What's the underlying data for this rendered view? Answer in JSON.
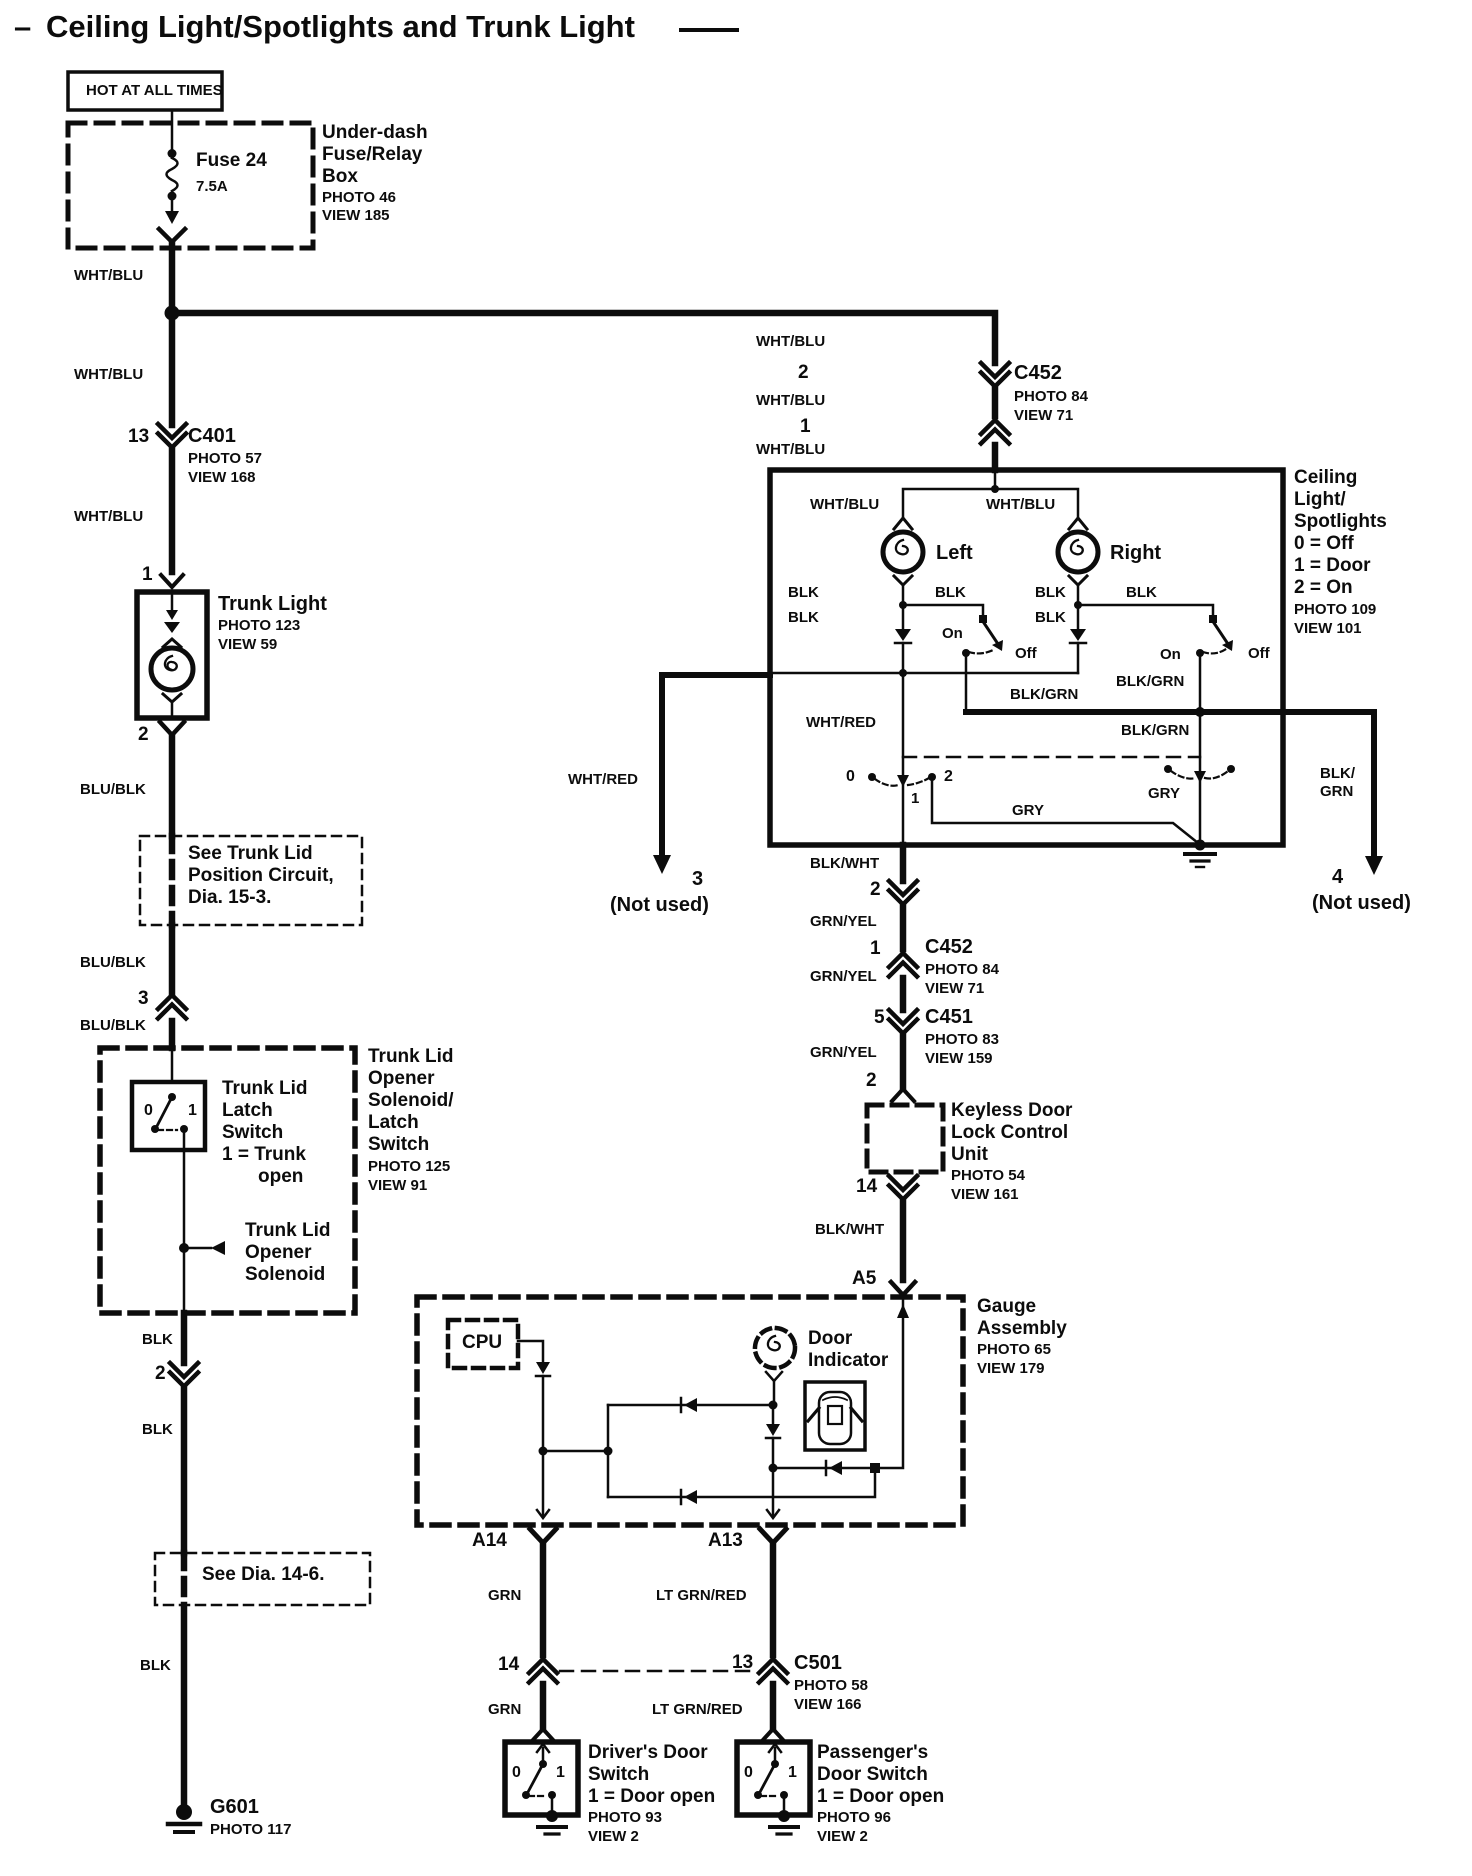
{
  "colors": {
    "ink": "#0c0c0c",
    "paper": "#ffffff"
  },
  "title": {
    "dash": "–",
    "text": "Ceiling Light/Spotlights and Trunk Light"
  },
  "power": {
    "hot_label": "HOT AT ALL TIMES",
    "fuse_name": "Fuse 24",
    "fuse_rating": "7.5A",
    "comp_line1": "Under-dash",
    "comp_line2": "Fuse/Relay",
    "comp_line3": "Box",
    "photo": "PHOTO 46",
    "view": "VIEW 185"
  },
  "trunk_branch": {
    "wire_top": "WHT/BLU",
    "wire_mid": "WHT/BLU",
    "c401_pin": "13",
    "c401_name": "C401",
    "c401_photo": "PHOTO 57",
    "c401_view": "VIEW 168",
    "wire_low": "WHT/BLU",
    "light_pin_in": "1",
    "light_name": "Trunk Light",
    "light_photo": "PHOTO 123",
    "light_view": "VIEW 59",
    "light_pin_out": "2",
    "wire_blu_blk_1": "BLU/BLK",
    "see_note_line1": "See Trunk Lid",
    "see_note_line2": "Position Circuit,",
    "see_note_line3": "Dia. 15-3.",
    "wire_blu_blk_2": "BLU/BLK",
    "splice_pin": "3",
    "wire_blu_blk_3": "BLU/BLK",
    "latch_line1": "Trunk Lid",
    "latch_line2": "Latch",
    "latch_line3": "Switch",
    "latch_line4": "1 = Trunk",
    "latch_line5": "open",
    "latch_pos0": "0",
    "latch_pos1": "1",
    "sol_line1": "Trunk Lid",
    "sol_line2": "Opener",
    "sol_line3": "Solenoid",
    "comp_line1": "Trunk Lid",
    "comp_line2": "Opener",
    "comp_line3": "Solenoid/",
    "comp_line4": "Latch",
    "comp_line5": "Switch",
    "comp_photo": "PHOTO 125",
    "comp_view": "VIEW 91",
    "wire_blk_1": "BLK",
    "splice2_pin": "2",
    "wire_blk_2": "BLK",
    "see_dia_note": "See Dia. 14-6.",
    "wire_blk_3": "BLK",
    "ground_name": "G601",
    "ground_photo": "PHOTO 117"
  },
  "ceiling_feed": {
    "wire_1": "WHT/BLU",
    "c452_pin_in": "2",
    "c452_name": "C452",
    "c452_photo": "PHOTO 84",
    "c452_view": "VIEW 71",
    "wire_2": "WHT/BLU",
    "c452_pin_out": "1",
    "wire_3": "WHT/BLU"
  },
  "ceiling_box": {
    "label_line1": "Ceiling",
    "label_line2": "Light/",
    "label_line3": "Spotlights",
    "label_line4": "0 = Off",
    "label_line5": "1 = Door",
    "label_line6": "2 = On",
    "label_photo": "PHOTO 109",
    "label_view": "VIEW 101",
    "wire_left_lamp": "WHT/BLU",
    "wire_right_lamp": "WHT/BLU",
    "left_lamp": "Left",
    "right_lamp": "Right",
    "blk_left_col": "BLK",
    "blk_left_branch": "BLK",
    "blk_left_col2": "BLK",
    "blk_right_col": "BLK",
    "blk_right_branch": "BLK",
    "blk_right_col2": "BLK",
    "left_switch_on": "On",
    "left_switch_off": "Off",
    "right_switch_on": "On",
    "right_switch_off": "Off",
    "blk_grn_rail": "BLK/GRN",
    "blk_grn_right_up": "BLK/GRN",
    "blk_grn_right_down": "BLK/GRN",
    "wht_red": "WHT/RED",
    "sel_pos0": "0",
    "sel_pos1": "1",
    "sel_pos2": "2",
    "gry_right": "GRY",
    "gry_left": "GRY"
  },
  "not_used_left": {
    "wire": "WHT/RED",
    "pin": "3",
    "note": "(Not used)"
  },
  "not_used_right": {
    "wire_line1": "BLK/",
    "wire_line2": "GRN",
    "pin": "4",
    "note": "(Not used)"
  },
  "keyless_branch": {
    "wire_blk_wht": "BLK/WHT",
    "pin_2": "2",
    "wire_grn_yel_1": "GRN/YEL",
    "c452_pin": "1",
    "c452_name": "C452",
    "c452_photo": "PHOTO 84",
    "c452_view": "VIEW 71",
    "wire_grn_yel_2": "GRN/YEL",
    "c451_pin": "5",
    "c451_name": "C451",
    "c451_photo": "PHOTO 83",
    "c451_view": "VIEW 159",
    "wire_grn_yel_3": "GRN/YEL",
    "unit_pin_in": "2",
    "unit_line1": "Keyless Door",
    "unit_line2": "Lock Control",
    "unit_line3": "Unit",
    "unit_photo": "PHOTO 54",
    "unit_view": "VIEW 161",
    "unit_pin_out": "14",
    "wire_blk_wht_2": "BLK/WHT",
    "gauge_pin": "A5"
  },
  "gauge": {
    "label_line1": "Gauge",
    "label_line2": "Assembly",
    "label_photo": "PHOTO 65",
    "label_view": "VIEW 179",
    "cpu": "CPU",
    "ind_line1": "Door",
    "ind_line2": "Indicator",
    "pin_a14": "A14",
    "pin_a13": "A13"
  },
  "door_switches": {
    "wire_grn_1": "GRN",
    "wire_ltgrn_1": "LT GRN/RED",
    "c501_pin_left": "14",
    "c501_pin_right": "13",
    "c501_name": "C501",
    "c501_photo": "PHOTO 58",
    "c501_view": "VIEW 166",
    "wire_grn_2": "GRN",
    "wire_ltgrn_2": "LT GRN/RED",
    "driver_line1": "Driver's Door",
    "driver_line2": "Switch",
    "driver_line3": "1 = Door open",
    "driver_photo": "PHOTO 93",
    "driver_view": "VIEW 2",
    "driver_pos0": "0",
    "driver_pos1": "1",
    "pass_line1": "Passenger's",
    "pass_line2": "Door Switch",
    "pass_line3": "1 = Door open",
    "pass_photo": "PHOTO 96",
    "pass_view": "VIEW 2",
    "pass_pos0": "0",
    "pass_pos1": "1"
  }
}
